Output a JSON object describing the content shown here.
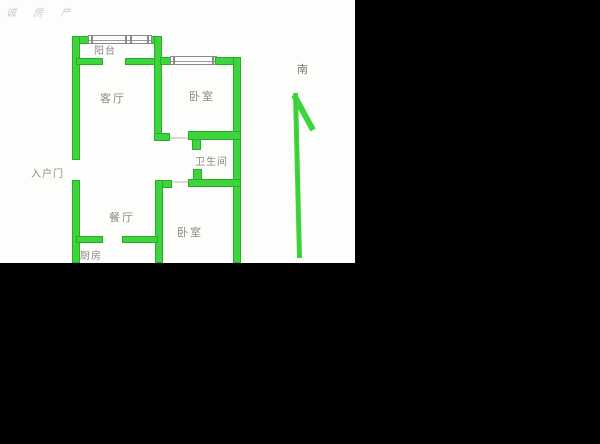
{
  "watermark": "诚 房 产",
  "compass": {
    "label": "南"
  },
  "rooms": {
    "balcony": "阳台",
    "living_room": "客厅",
    "bedroom_top": "卧室",
    "bathroom": "卫生间",
    "entrance": "入户门",
    "dining_room": "餐厅",
    "kitchen": "厨房",
    "bedroom_bottom": "卧室"
  },
  "colors": {
    "wall": "#3ed43e",
    "wall_border": "#27ad27",
    "floor": "#fdfdfb",
    "background": "#000000",
    "label_text": "#8b8b80",
    "watermark_text": "#c9c9c9"
  }
}
